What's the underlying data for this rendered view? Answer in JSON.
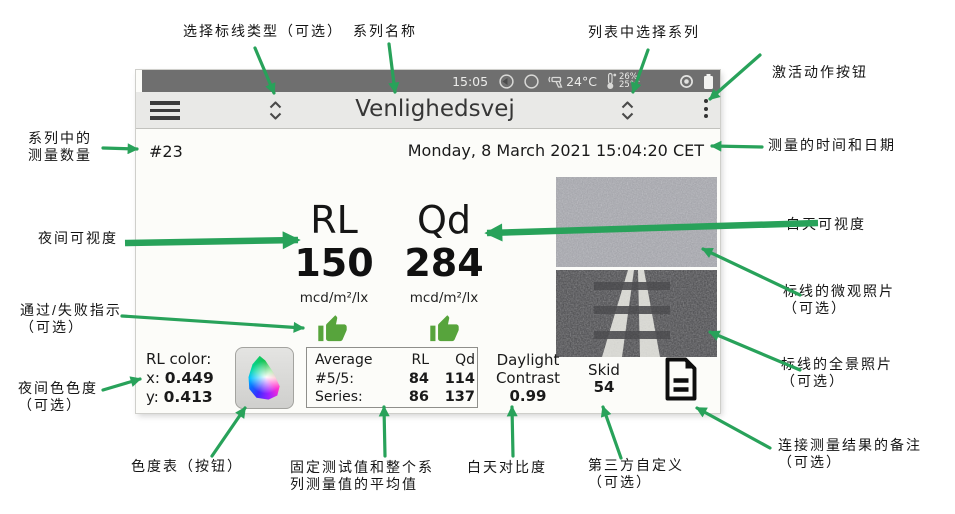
{
  "colors": {
    "arrow_green": "#28a25a",
    "thumb_green": "#57a43c",
    "statusbar_bg": "#6f6f6f",
    "toolbar_bg": "#e9e9e7"
  },
  "annotations": {
    "select_marking_type": "选择标线类型（可选）",
    "series_name": "系列名称",
    "select_series_from_list": "列表中选择系列",
    "activate_action_button": "激活动作按钮",
    "series_count_l1": "系列中的",
    "series_count_l2": "测量数量",
    "night_visibility": "夜间可视度",
    "pass_fail_l1": "通过/失败指示",
    "pass_fail_l2": "（可选）",
    "night_color_l1": "夜间色色度",
    "night_color_l2": "（可选）",
    "time_date": "测量的时间和日期",
    "day_visibility": "白天可视度",
    "macro_photo_l1": "标线的微观照片",
    "macro_photo_l2": "（可选）",
    "pano_photo_l1": "标线的全景照片",
    "pano_photo_l2": "（可选）",
    "note_l1": "连接测量结果的备注",
    "note_l2": "（可选）",
    "chroma_button": "色度表（按钮）",
    "avg_l1": "固定测试值和整个系",
    "avg_l2": "列测量值的平均值",
    "daylight_contrast": "白天对比度",
    "third_party_l1": "第三方自定义",
    "third_party_l2": "（可选）"
  },
  "device": {
    "statusbar": {
      "time": "15:05",
      "ir_temp": "24°C",
      "humidity": "26%",
      "ambient_temp": "25°C"
    },
    "toolbar": {
      "title": "Venlighedsvej"
    },
    "header": {
      "count": "#23",
      "datetime": "Monday, 8 March 2021 15:04:20 CET"
    },
    "night": {
      "label": "RL",
      "value": "150",
      "unit": "mcd/m²/lx"
    },
    "day": {
      "label": "Qd",
      "value": "284",
      "unit": "mcd/m²/lx"
    },
    "rl_color": {
      "title": "RL color:",
      "x_label": "x:",
      "x": "0.449",
      "y_label": "y:",
      "y": "0.413"
    },
    "average": {
      "header": [
        "Average",
        "RL",
        "Qd"
      ],
      "rows": [
        [
          "#5/5:",
          "84",
          "114"
        ],
        [
          "Series:",
          "86",
          "137"
        ]
      ]
    },
    "daylight": {
      "l1": "Daylight",
      "l2": "Contrast",
      "value": "0.99"
    },
    "skid": {
      "label": "Skid",
      "value": "54"
    }
  }
}
